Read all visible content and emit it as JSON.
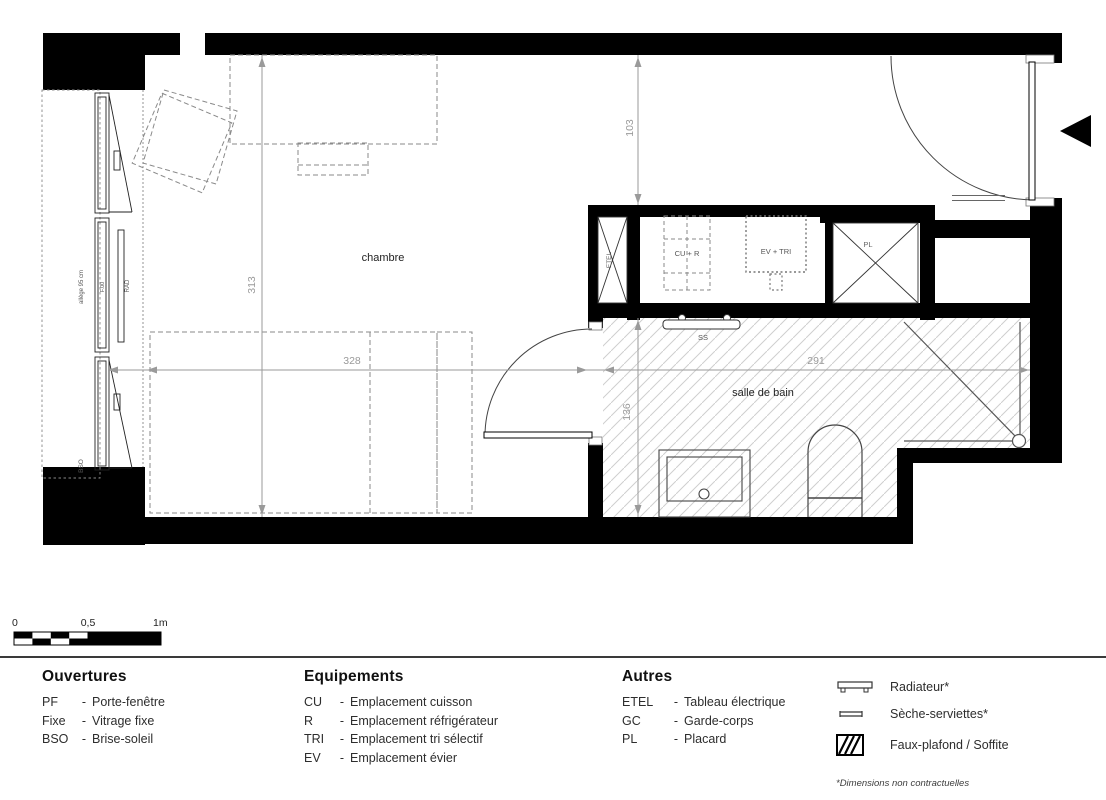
{
  "plan": {
    "rooms": {
      "chambre": "chambre",
      "salle_de_bain": "salle de bain"
    },
    "labels": {
      "etel": "ETEL",
      "cu_r": "CU + R",
      "ev_tri": "EV + TRI",
      "pl": "PL",
      "ss": "SS",
      "rad": "RAD",
      "bso": "BSO",
      "f00": "F.00",
      "allege": "allège 95 cm"
    },
    "dims": {
      "d313": "313",
      "d328": "328",
      "d291": "291",
      "d103": "103",
      "d136": "136"
    }
  },
  "scalebar": {
    "t0": "0",
    "t05": "0,5",
    "t1": "1m"
  },
  "legend": {
    "sep": "-",
    "ouvertures": {
      "title": "Ouvertures",
      "items": [
        {
          "abbr": "PF",
          "label": "Porte-fenêtre"
        },
        {
          "abbr": "Fixe",
          "label": "Vitrage fixe"
        },
        {
          "abbr": "BSO",
          "label": "Brise-soleil"
        }
      ]
    },
    "equipements": {
      "title": "Equipements",
      "items": [
        {
          "abbr": "CU",
          "label": "Emplacement cuisson"
        },
        {
          "abbr": "R",
          "label": "Emplacement réfrigérateur"
        },
        {
          "abbr": "TRI",
          "label": "Emplacement tri sélectif"
        },
        {
          "abbr": "EV",
          "label": "Emplacement évier"
        }
      ]
    },
    "autres": {
      "title": "Autres",
      "items": [
        {
          "abbr": "ETEL",
          "label": "Tableau électrique"
        },
        {
          "abbr": "GC",
          "label": "Garde-corps"
        },
        {
          "abbr": "PL",
          "label": "Placard"
        }
      ]
    },
    "symbols": [
      {
        "label": "Radiateur*"
      },
      {
        "label": "Sèche-serviettes*"
      },
      {
        "label": "Faux-plafond / Soffite"
      }
    ],
    "footnote": "*Dimensions non contractuelles"
  },
  "colors": {
    "wall": "#000000",
    "dimension": "#9a9a9a",
    "hatch": "#cfcfcf"
  }
}
